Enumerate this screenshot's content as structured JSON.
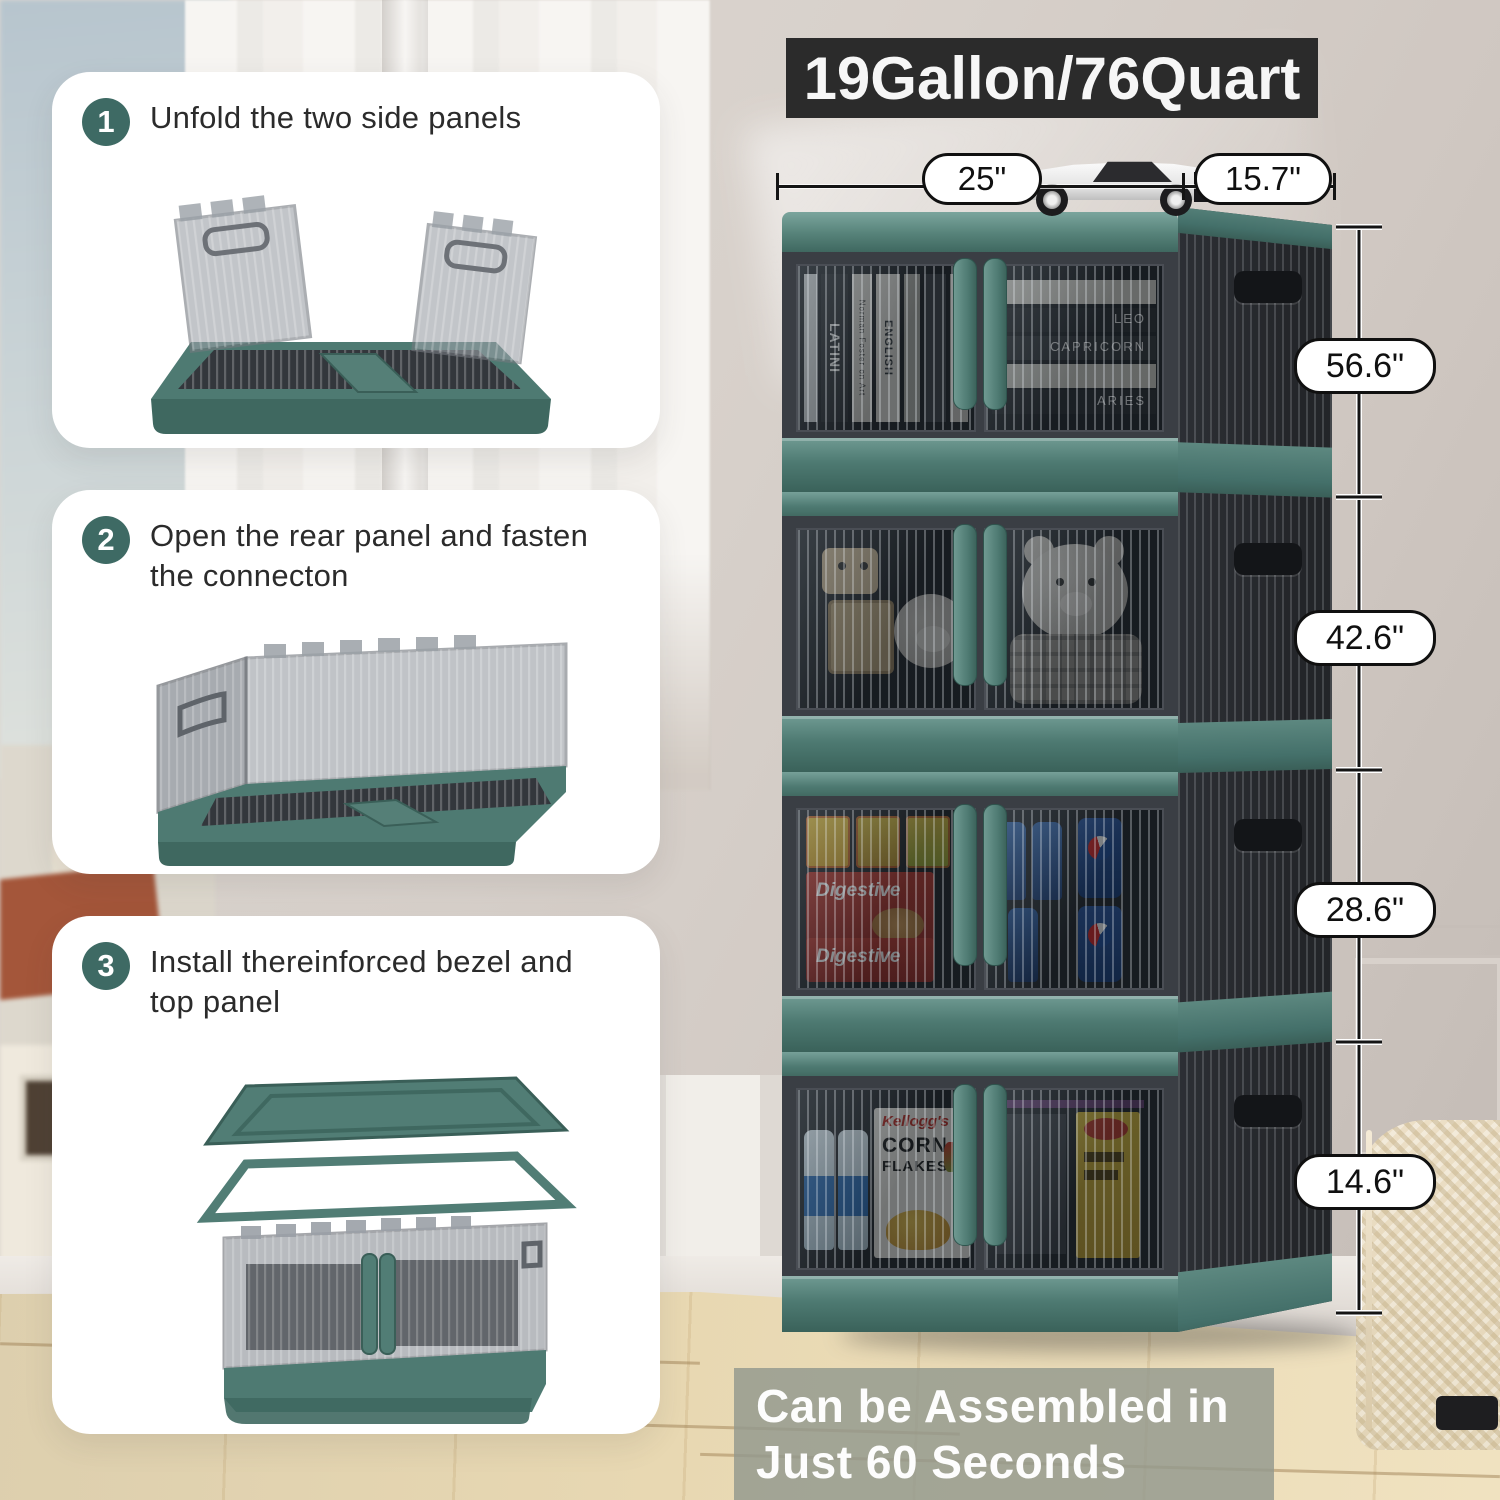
{
  "banner": {
    "title": "19Gallon/76Quart"
  },
  "steps": [
    {
      "number": "1",
      "line1": "Unfold the two side panels",
      "line2": ""
    },
    {
      "number": "2",
      "line1": "Open the rear panel and fasten",
      "line2": "the connecton"
    },
    {
      "number": "3",
      "line1": "Install thereinforced bezel and",
      "line2": "top panel"
    }
  ],
  "dimensions": {
    "width": "25\"",
    "depth": "15.7\"",
    "heights": [
      "56.6\"",
      "42.6\"",
      "28.6\"",
      "14.6\""
    ]
  },
  "footer": {
    "line1": "Can be Assembled in",
    "line2": "Just 60 Seconds"
  },
  "cabinet_contents": {
    "books": [
      "LATINI",
      "Norman Foster on Art",
      "ENGLISH",
      "LEO",
      "CAPRICORN",
      "ARIES"
    ],
    "snack_label": "Digestive",
    "cereal_brand": "Kellogg's",
    "cereal_line1": "CORN",
    "cereal_line2": "FLAKES"
  },
  "colors": {
    "teal_frame": "#4e7a72",
    "charcoal": "#3a3e44",
    "badge_teal": "#3e6a64",
    "banner_bg": "#2b2b2b",
    "footer_overlay": "#929a8d"
  }
}
